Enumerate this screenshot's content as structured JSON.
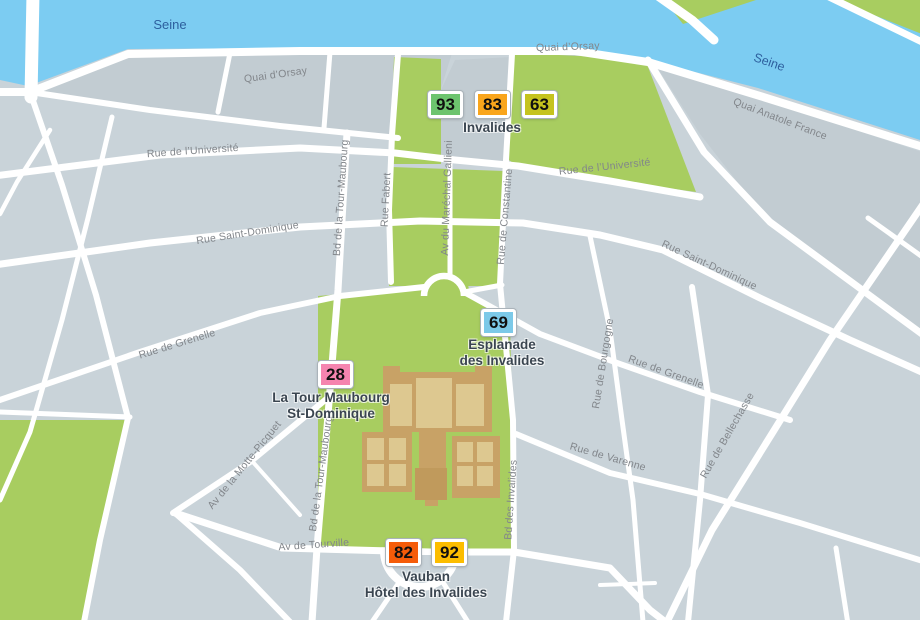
{
  "title": "Invalides area map (Paris 7e)",
  "colors": {
    "water": "#7cccf2",
    "park": "#a8cd60",
    "block": "#c9d3d9",
    "block_alt": "#c2ccd2",
    "road": "#ffffff",
    "building_wall": "#c8a266",
    "building_court": "#ddc890",
    "building_dome": "#c09a5c",
    "street_label": "#82868b",
    "river_label_color": "#2d5f9e",
    "place_label": "#3a4550"
  },
  "river_label": "Seine",
  "streets": {
    "quai_orsay": "Quai d’Orsay",
    "quai_anatole": "Quai Anatole France",
    "universite": "Rue de l’Université",
    "st_dominique": "Rue Saint-Dominique",
    "grenelle": "Rue de Grenelle",
    "varenne": "Rue de Varenne",
    "bourgogne": "Rue de Bourgogne",
    "bellechasse": "Rue de Bellechasse",
    "bd_invalides": "Bd des Invalides",
    "tour_maubourg": "Bd de la Tour-Maubourg",
    "fabert": "Rue Fabert",
    "gallieni": "Av du Maréchal Gallieni",
    "constantine": "Rue de Constantine",
    "motte_picquet": "Av de la Motte-Picquet",
    "tourville": "Av de Tourville"
  },
  "stops": [
    {
      "name": "Invalides",
      "label_lines": [
        "Invalides"
      ],
      "lines": [
        {
          "num": "93",
          "color": "#6dc46e"
        },
        {
          "num": "83",
          "color": "#f9a51b"
        },
        {
          "num": "63",
          "color": "#c5c31e"
        }
      ]
    },
    {
      "name": "Esplanade des Invalides",
      "label_lines": [
        "Esplanade",
        "des Invalides"
      ],
      "lines": [
        {
          "num": "69",
          "color": "#7cc9e8"
        }
      ]
    },
    {
      "name": "La Tour Maubourg St-Dominique",
      "label_lines": [
        "La Tour Maubourg",
        "St-Dominique"
      ],
      "lines": [
        {
          "num": "28",
          "color": "#f584af"
        }
      ]
    },
    {
      "name": "Vauban Hôtel des Invalides",
      "label_lines": [
        "Vauban",
        "Hôtel des Invalides"
      ],
      "lines": [
        {
          "num": "82",
          "color": "#f55c09"
        },
        {
          "num": "92",
          "color": "#fcbd00"
        }
      ]
    }
  ]
}
